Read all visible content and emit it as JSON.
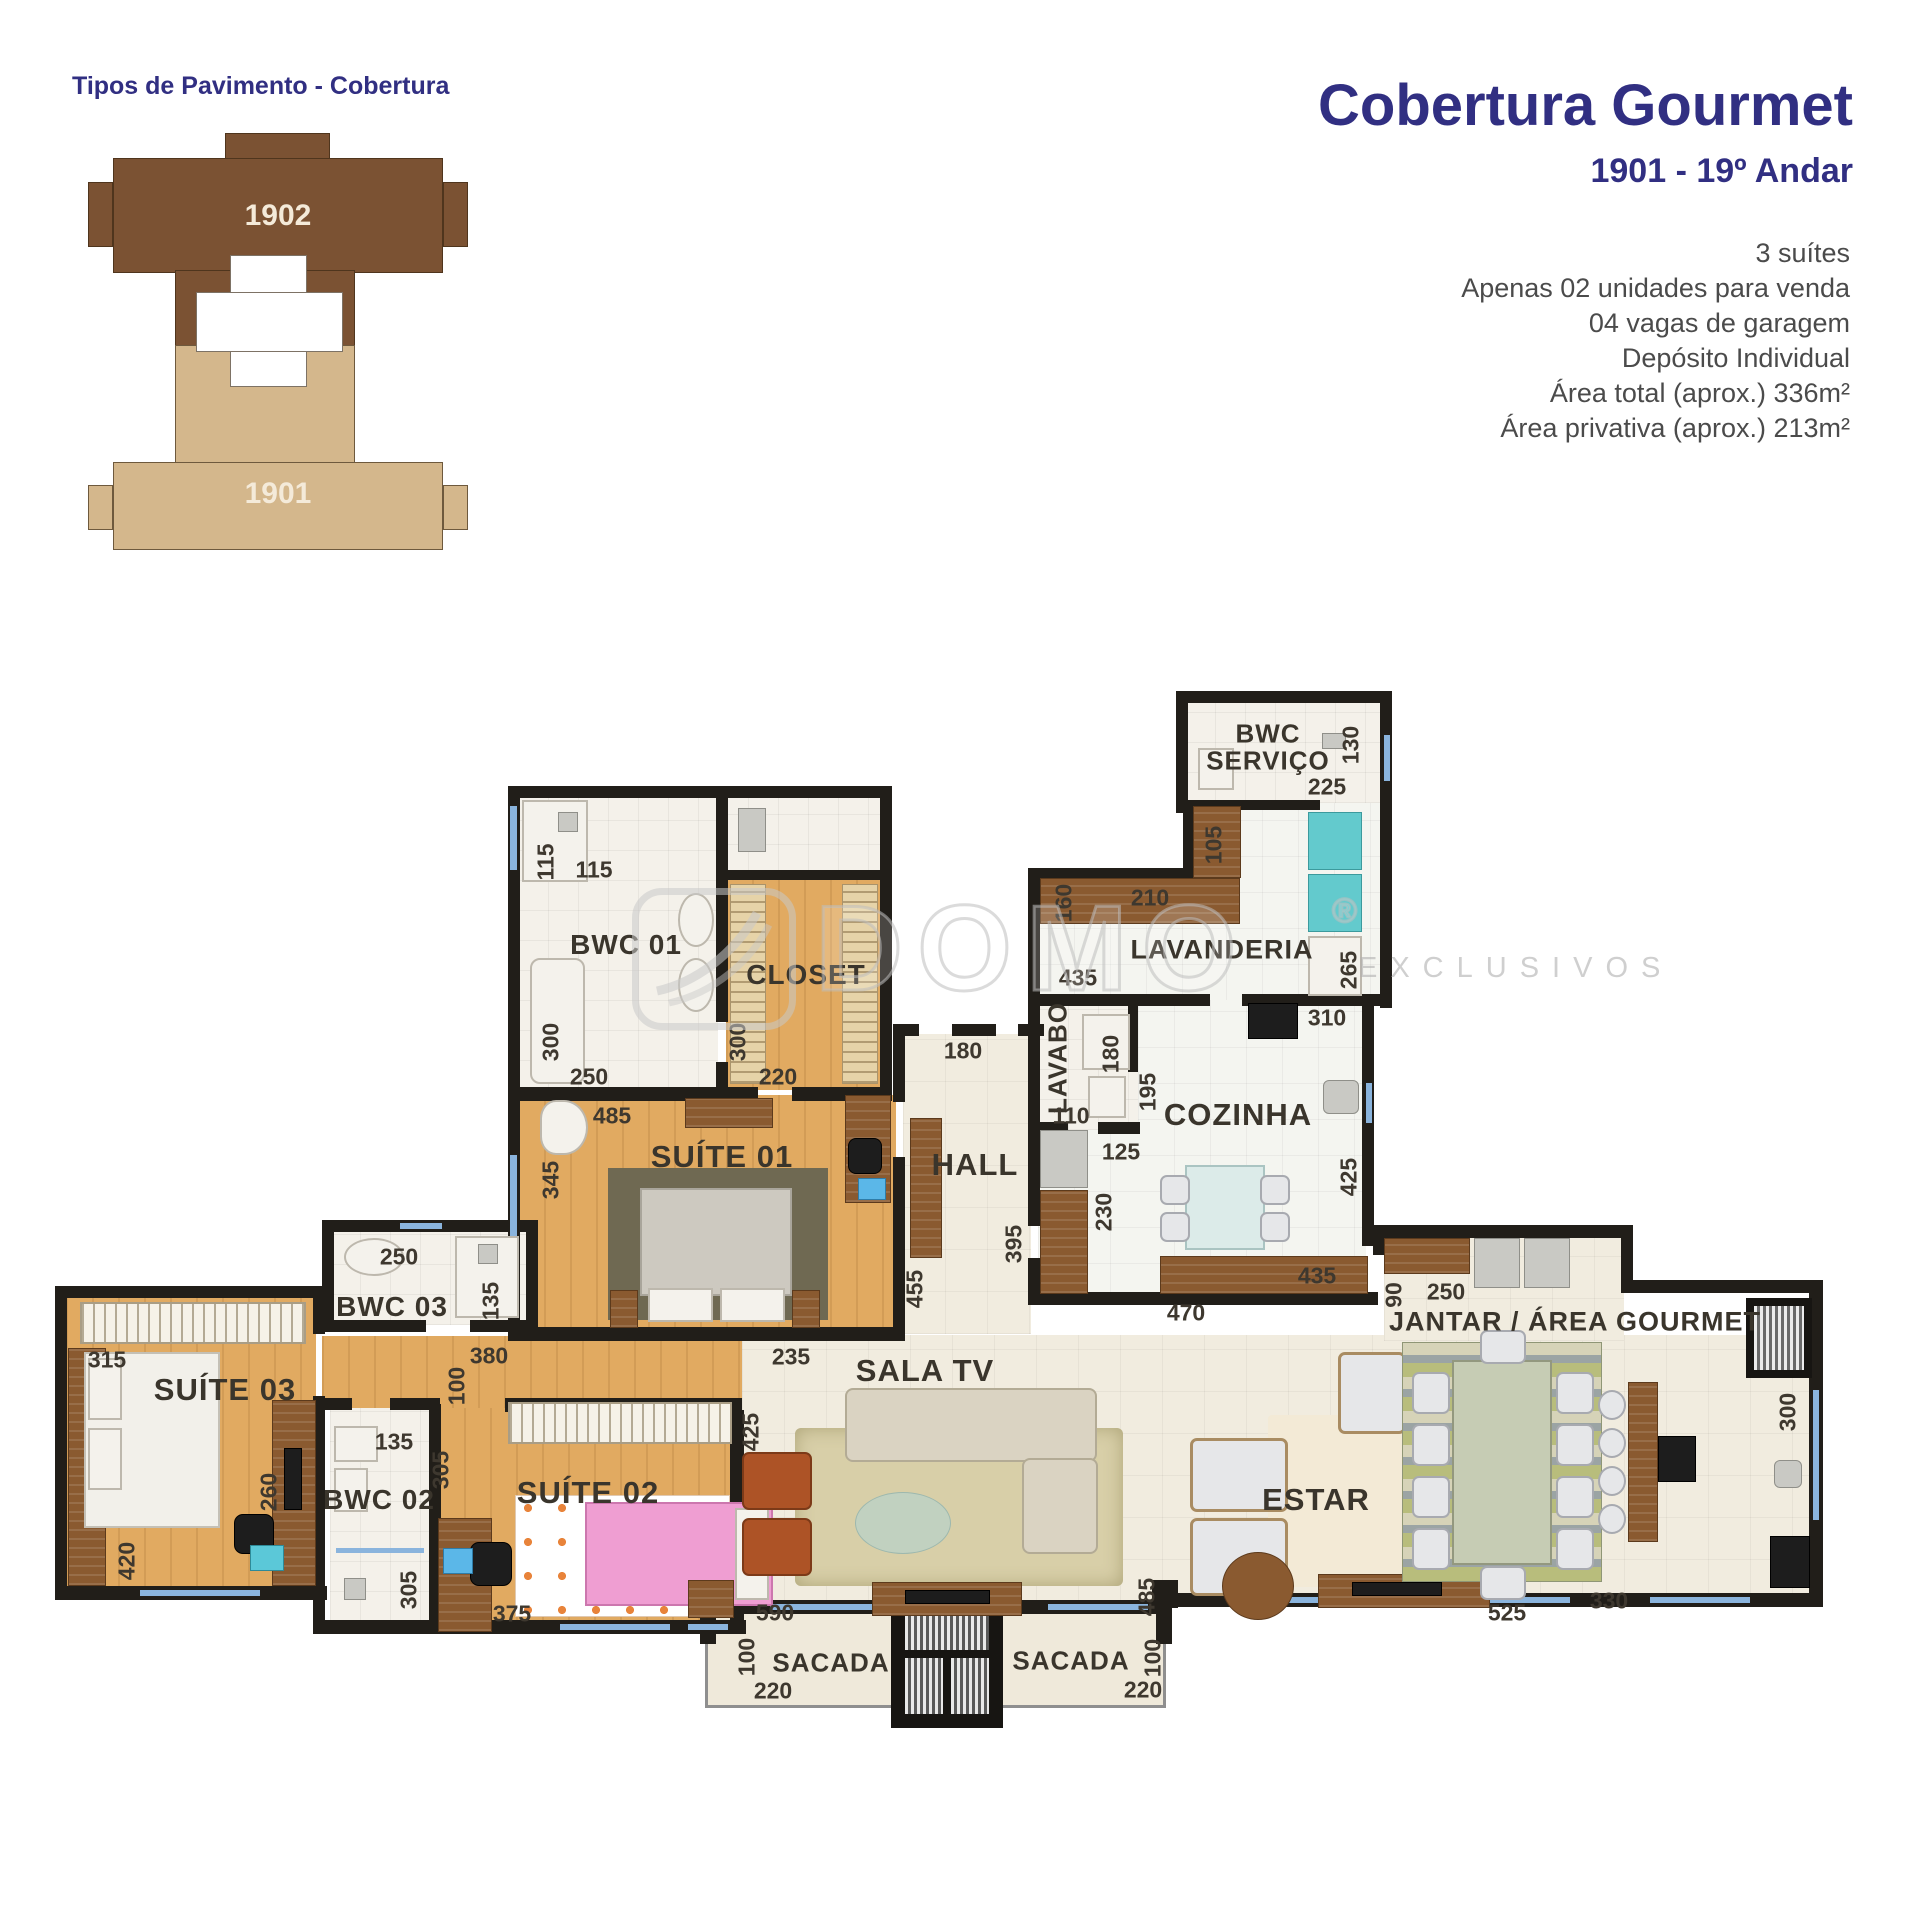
{
  "legend": {
    "title": "Tipos de Pavimento - Cobertura",
    "unit_top": "1902",
    "unit_bottom": "1901"
  },
  "header": {
    "title": "Cobertura Gourmet",
    "subtitle": "1901 - 19º Andar",
    "features": [
      "3 suítes",
      "Apenas 02 unidades para venda",
      "04 vagas de garagem",
      "Depósito Individual",
      "Área total (aprox.) 336m²",
      "Área privativa (aprox.) 213m²"
    ]
  },
  "watermark": {
    "brand": "DOMO",
    "registered": "®",
    "tagline": "EXCLUSIVOS"
  },
  "palette": {
    "accent_navy": "#312f82",
    "wall": "#211e19",
    "wood_floor": "#e1aa61",
    "tile_floor": "#f1ecdf",
    "unit_1902": "#7b5233",
    "unit_1901": "#d4b78c",
    "window_glass": "#8ab4dd",
    "washer_teal": "#63cacd",
    "bed_pink": "#ef9ed2",
    "armchair_rust": "#ad5326"
  },
  "rooms": {
    "bwc_servico": {
      "label": "BWC SERVIÇO"
    },
    "lavanderia": {
      "label": "LAVANDERIA"
    },
    "lavabo": {
      "label": "LAVABO"
    },
    "cozinha": {
      "label": "COZINHA"
    },
    "hall": {
      "label": "HALL"
    },
    "bwc01": {
      "label": "BWC 01"
    },
    "closet": {
      "label": "CLOSET"
    },
    "suite01": {
      "label": "SUÍTE 01"
    },
    "bwc03": {
      "label": "BWC 03"
    },
    "suite03": {
      "label": "SUÍTE 03"
    },
    "bwc02": {
      "label": "BWC 02"
    },
    "suite02": {
      "label": "SUÍTE 02"
    },
    "sala_tv": {
      "label": "SALA TV"
    },
    "estar": {
      "label": "ESTAR"
    },
    "jantar": {
      "label": "JANTAR / ÁREA GOURMET"
    },
    "sacada_left": {
      "label": "SACADA"
    },
    "sacada_right": {
      "label": "SACADA"
    }
  },
  "dims": {
    "sv_h": "130",
    "sv_w": "225",
    "lv_cab": "105",
    "lv_counter": "210",
    "lv_left": "160",
    "lv_w": "435",
    "lv_h": "265",
    "lb_h": "180",
    "lb_w": "110",
    "cz_top": "310",
    "cz_s1": "195",
    "cz_s2": "125",
    "cz_s3": "230",
    "cz_h": "425",
    "cz_counter": "435",
    "cz_w": "470",
    "cz_pass": "90",
    "hl_door": "180",
    "hl_h1": "395",
    "hl_h2": "455",
    "b1_sh_h": "115",
    "b1_sh_w": "115",
    "b1_h": "300",
    "b1_w": "250",
    "cl_h": "300",
    "cl_w": "220",
    "s1_w": "485",
    "s1_h": "345",
    "s1_d": "235",
    "b3_w": "250",
    "b3_h": "135",
    "s3_w": "315",
    "s3_d": "260",
    "s3_h": "420",
    "cr_w": "380",
    "cr_h": "100",
    "b2_w": "135",
    "b2_h1": "305",
    "b2_h2": "305",
    "s2_w": "375",
    "st_h": "425",
    "st_w": "590",
    "st_d": "485",
    "jt_top": "250",
    "jt_h": "300",
    "jt_w1": "330",
    "jt_w2": "525",
    "scl_h": "100",
    "scl_w": "220",
    "scr_h": "100",
    "scr_w": "220"
  }
}
